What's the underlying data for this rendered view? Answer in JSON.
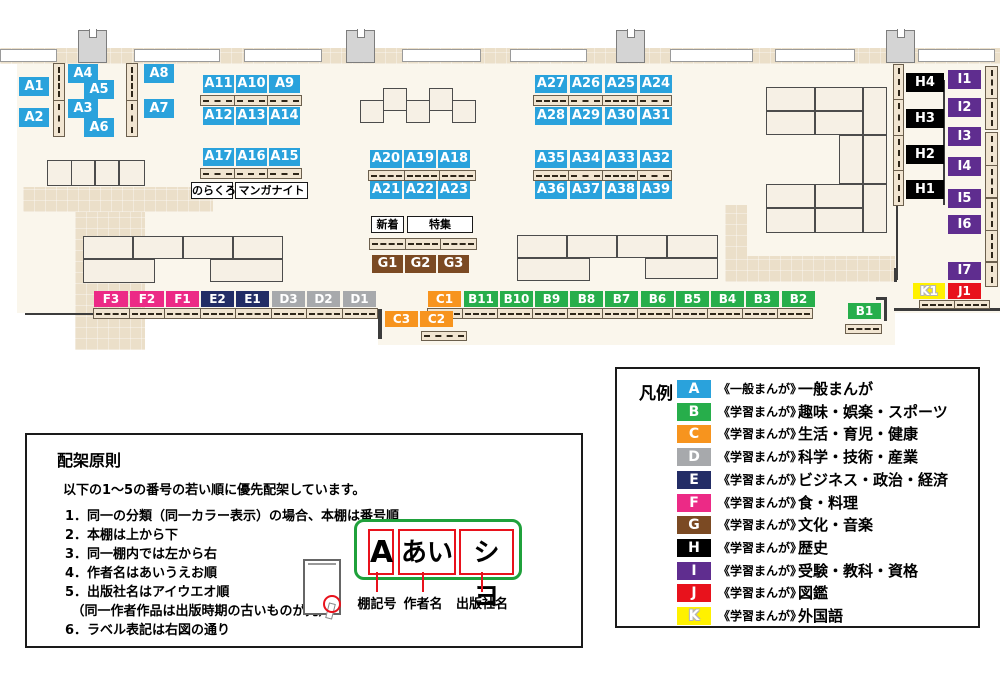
{
  "colors": {
    "A": "#2AA2DC",
    "B": "#27AE4B",
    "C": "#F7941E",
    "D": "#A7A9AC",
    "E": "#232D66",
    "F": "#EC2A86",
    "G": "#7B4A23",
    "H": "#000000",
    "I": "#5F2D8F",
    "J": "#E8121C",
    "K": "#FFF100"
  },
  "map": {
    "base": [
      [
        17,
        62,
        983,
        251
      ],
      [
        378,
        312,
        517,
        33
      ]
    ],
    "paths": [
      [
        0,
        48,
        1000,
        16
      ],
      [
        23,
        187,
        190,
        25
      ],
      [
        75,
        212,
        70,
        138
      ],
      [
        725,
        205,
        22,
        53
      ],
      [
        725,
        256,
        170,
        26
      ]
    ],
    "walls": [
      [
        0,
        49,
        57,
        13
      ],
      [
        134,
        49,
        86,
        13
      ],
      [
        244,
        49,
        78,
        13
      ],
      [
        402,
        49,
        79,
        13
      ],
      [
        510,
        49,
        77,
        13
      ],
      [
        670,
        49,
        83,
        13
      ],
      [
        775,
        49,
        80,
        13
      ],
      [
        918,
        49,
        77,
        13
      ]
    ],
    "pillars": [
      [
        78,
        30,
        29,
        33
      ],
      [
        346,
        30,
        29,
        33
      ],
      [
        616,
        30,
        29,
        33
      ],
      [
        886,
        30,
        29,
        33
      ]
    ],
    "tables": [
      [
        47,
        160,
        25,
        26
      ],
      [
        71,
        160,
        24,
        26
      ],
      [
        95,
        160,
        24,
        26
      ],
      [
        119,
        160,
        26,
        26
      ],
      [
        83,
        236,
        50,
        23
      ],
      [
        133,
        236,
        50,
        23
      ],
      [
        183,
        236,
        50,
        23
      ],
      [
        233,
        236,
        50,
        23
      ],
      [
        83,
        259,
        72,
        24
      ],
      [
        210,
        259,
        73,
        23
      ],
      [
        360,
        100,
        24,
        23
      ],
      [
        383,
        88,
        24,
        23
      ],
      [
        406,
        100,
        24,
        23
      ],
      [
        429,
        88,
        24,
        23
      ],
      [
        452,
        100,
        24,
        23
      ],
      [
        517,
        235,
        50,
        23
      ],
      [
        567,
        235,
        50,
        23
      ],
      [
        617,
        235,
        50,
        23
      ],
      [
        667,
        235,
        51,
        23
      ],
      [
        517,
        258,
        73,
        23
      ],
      [
        645,
        258,
        73,
        21
      ],
      [
        766,
        87,
        49,
        24
      ],
      [
        815,
        87,
        48,
        24
      ],
      [
        766,
        111,
        49,
        24
      ],
      [
        815,
        111,
        48,
        24
      ],
      [
        863,
        87,
        24,
        48
      ],
      [
        839,
        135,
        24,
        49
      ],
      [
        863,
        135,
        24,
        49
      ],
      [
        766,
        184,
        49,
        24
      ],
      [
        815,
        184,
        48,
        24
      ],
      [
        766,
        208,
        49,
        25
      ],
      [
        815,
        208,
        48,
        25
      ],
      [
        863,
        184,
        24,
        49
      ]
    ],
    "shelves_h": [
      [
        200,
        95,
        102,
        11,
        3
      ],
      [
        200,
        168,
        102,
        11,
        3
      ],
      [
        368,
        170,
        108,
        11,
        3
      ],
      [
        533,
        95,
        139,
        11,
        4
      ],
      [
        533,
        170,
        139,
        11,
        4
      ],
      [
        369,
        238,
        108,
        12,
        3
      ],
      [
        93,
        308,
        285,
        11,
        8
      ],
      [
        427,
        308,
        386,
        11,
        11
      ],
      [
        421,
        331,
        46,
        10,
        1
      ],
      [
        845,
        324,
        37,
        10,
        1
      ],
      [
        919,
        300,
        71,
        9,
        2
      ]
    ],
    "shelves_v": [
      [
        53,
        63,
        12,
        74,
        2
      ],
      [
        126,
        63,
        12,
        74,
        2
      ],
      [
        893,
        64,
        11,
        142,
        4
      ],
      [
        985,
        66,
        13,
        64,
        2
      ],
      [
        985,
        132,
        13,
        66,
        2
      ],
      [
        985,
        198,
        13,
        64,
        2
      ],
      [
        985,
        262,
        13,
        25,
        1
      ]
    ],
    "lines": [
      [
        25,
        313,
        68,
        2
      ],
      [
        378,
        309,
        4,
        30
      ],
      [
        884,
        297,
        3,
        24
      ],
      [
        876,
        297,
        11,
        3
      ],
      [
        894,
        268,
        3,
        14
      ],
      [
        894,
        308,
        106,
        3
      ],
      [
        943,
        80,
        2,
        125
      ],
      [
        896,
        206,
        2,
        74
      ]
    ],
    "labels": [
      {
        "t": "A1",
        "c": "A",
        "x": 19,
        "y": 77,
        "w": 30,
        "h": 19
      },
      {
        "t": "A2",
        "c": "A",
        "x": 19,
        "y": 108,
        "w": 30,
        "h": 19
      },
      {
        "t": "A4",
        "c": "A",
        "x": 68,
        "y": 64,
        "w": 30,
        "h": 19
      },
      {
        "t": "A5",
        "c": "A",
        "x": 84,
        "y": 80,
        "w": 30,
        "h": 19
      },
      {
        "t": "A3",
        "c": "A",
        "x": 68,
        "y": 99,
        "w": 30,
        "h": 19
      },
      {
        "t": "A6",
        "c": "A",
        "x": 84,
        "y": 118,
        "w": 30,
        "h": 19
      },
      {
        "t": "A8",
        "c": "A",
        "x": 144,
        "y": 64,
        "w": 30,
        "h": 19
      },
      {
        "t": "A7",
        "c": "A",
        "x": 144,
        "y": 99,
        "w": 30,
        "h": 19
      },
      {
        "t": "A11",
        "c": "A",
        "x": 203,
        "y": 75,
        "w": 31,
        "h": 18
      },
      {
        "t": "A10",
        "c": "A",
        "x": 236,
        "y": 75,
        "w": 31,
        "h": 18
      },
      {
        "t": "A9",
        "c": "A",
        "x": 269,
        "y": 75,
        "w": 31,
        "h": 18
      },
      {
        "t": "A12",
        "c": "A",
        "x": 203,
        "y": 107,
        "w": 31,
        "h": 18
      },
      {
        "t": "A13",
        "c": "A",
        "x": 236,
        "y": 107,
        "w": 31,
        "h": 18
      },
      {
        "t": "A14",
        "c": "A",
        "x": 269,
        "y": 107,
        "w": 31,
        "h": 18
      },
      {
        "t": "A17",
        "c": "A",
        "x": 203,
        "y": 148,
        "w": 31,
        "h": 18
      },
      {
        "t": "A16",
        "c": "A",
        "x": 236,
        "y": 148,
        "w": 31,
        "h": 18
      },
      {
        "t": "A15",
        "c": "A",
        "x": 269,
        "y": 148,
        "w": 31,
        "h": 18
      },
      {
        "t": "A20",
        "c": "A",
        "x": 370,
        "y": 150,
        "w": 32,
        "h": 18
      },
      {
        "t": "A19",
        "c": "A",
        "x": 404,
        "y": 150,
        "w": 32,
        "h": 18
      },
      {
        "t": "A18",
        "c": "A",
        "x": 438,
        "y": 150,
        "w": 32,
        "h": 18
      },
      {
        "t": "A21",
        "c": "A",
        "x": 370,
        "y": 181,
        "w": 32,
        "h": 18
      },
      {
        "t": "A22",
        "c": "A",
        "x": 404,
        "y": 181,
        "w": 32,
        "h": 18
      },
      {
        "t": "A23",
        "c": "A",
        "x": 438,
        "y": 181,
        "w": 32,
        "h": 18
      },
      {
        "t": "A27",
        "c": "A",
        "x": 535,
        "y": 75,
        "w": 32,
        "h": 18
      },
      {
        "t": "A26",
        "c": "A",
        "x": 570,
        "y": 75,
        "w": 32,
        "h": 18
      },
      {
        "t": "A25",
        "c": "A",
        "x": 605,
        "y": 75,
        "w": 32,
        "h": 18
      },
      {
        "t": "A24",
        "c": "A",
        "x": 640,
        "y": 75,
        "w": 32,
        "h": 18
      },
      {
        "t": "A28",
        "c": "A",
        "x": 535,
        "y": 107,
        "w": 32,
        "h": 18
      },
      {
        "t": "A29",
        "c": "A",
        "x": 570,
        "y": 107,
        "w": 32,
        "h": 18
      },
      {
        "t": "A30",
        "c": "A",
        "x": 605,
        "y": 107,
        "w": 32,
        "h": 18
      },
      {
        "t": "A31",
        "c": "A",
        "x": 640,
        "y": 107,
        "w": 32,
        "h": 18
      },
      {
        "t": "A35",
        "c": "A",
        "x": 535,
        "y": 150,
        "w": 32,
        "h": 18
      },
      {
        "t": "A34",
        "c": "A",
        "x": 570,
        "y": 150,
        "w": 32,
        "h": 18
      },
      {
        "t": "A33",
        "c": "A",
        "x": 605,
        "y": 150,
        "w": 32,
        "h": 18
      },
      {
        "t": "A32",
        "c": "A",
        "x": 640,
        "y": 150,
        "w": 32,
        "h": 18
      },
      {
        "t": "A36",
        "c": "A",
        "x": 535,
        "y": 181,
        "w": 32,
        "h": 18
      },
      {
        "t": "A37",
        "c": "A",
        "x": 570,
        "y": 181,
        "w": 32,
        "h": 18
      },
      {
        "t": "A38",
        "c": "A",
        "x": 605,
        "y": 181,
        "w": 32,
        "h": 18
      },
      {
        "t": "A39",
        "c": "A",
        "x": 640,
        "y": 181,
        "w": 32,
        "h": 18
      },
      {
        "t": "G1",
        "c": "G",
        "x": 372,
        "y": 255,
        "w": 31,
        "h": 18
      },
      {
        "t": "G2",
        "c": "G",
        "x": 405,
        "y": 255,
        "w": 31,
        "h": 18
      },
      {
        "t": "G3",
        "c": "G",
        "x": 438,
        "y": 255,
        "w": 31,
        "h": 18
      },
      {
        "t": "F3",
        "c": "F",
        "x": 94,
        "y": 291,
        "w": 34,
        "h": 16
      },
      {
        "t": "F2",
        "c": "F",
        "x": 130,
        "y": 291,
        "w": 34,
        "h": 16
      },
      {
        "t": "F1",
        "c": "F",
        "x": 166,
        "y": 291,
        "w": 33,
        "h": 16
      },
      {
        "t": "E2",
        "c": "E",
        "x": 201,
        "y": 291,
        "w": 33,
        "h": 16
      },
      {
        "t": "E1",
        "c": "E",
        "x": 236,
        "y": 291,
        "w": 33,
        "h": 16
      },
      {
        "t": "D3",
        "c": "D",
        "x": 272,
        "y": 291,
        "w": 33,
        "h": 16
      },
      {
        "t": "D2",
        "c": "D",
        "x": 307,
        "y": 291,
        "w": 33,
        "h": 16
      },
      {
        "t": "D1",
        "c": "D",
        "x": 343,
        "y": 291,
        "w": 33,
        "h": 16
      },
      {
        "t": "C1",
        "c": "C",
        "x": 428,
        "y": 291,
        "w": 33,
        "h": 16
      },
      {
        "t": "B11",
        "c": "B",
        "x": 464,
        "y": 291,
        "w": 34,
        "h": 16
      },
      {
        "t": "B10",
        "c": "B",
        "x": 500,
        "y": 291,
        "w": 33,
        "h": 16
      },
      {
        "t": "B9",
        "c": "B",
        "x": 535,
        "y": 291,
        "w": 33,
        "h": 16
      },
      {
        "t": "B8",
        "c": "B",
        "x": 570,
        "y": 291,
        "w": 33,
        "h": 16
      },
      {
        "t": "B7",
        "c": "B",
        "x": 605,
        "y": 291,
        "w": 33,
        "h": 16
      },
      {
        "t": "B6",
        "c": "B",
        "x": 641,
        "y": 291,
        "w": 33,
        "h": 16
      },
      {
        "t": "B5",
        "c": "B",
        "x": 676,
        "y": 291,
        "w": 33,
        "h": 16
      },
      {
        "t": "B4",
        "c": "B",
        "x": 711,
        "y": 291,
        "w": 33,
        "h": 16
      },
      {
        "t": "B3",
        "c": "B",
        "x": 746,
        "y": 291,
        "w": 33,
        "h": 16
      },
      {
        "t": "B2",
        "c": "B",
        "x": 782,
        "y": 291,
        "w": 33,
        "h": 16
      },
      {
        "t": "C3",
        "c": "C",
        "x": 385,
        "y": 311,
        "w": 33,
        "h": 16
      },
      {
        "t": "C2",
        "c": "C",
        "x": 420,
        "y": 311,
        "w": 33,
        "h": 16
      },
      {
        "t": "B1",
        "c": "B",
        "x": 848,
        "y": 303,
        "w": 33,
        "h": 16
      },
      {
        "t": "H4",
        "c": "H",
        "x": 906,
        "y": 73,
        "w": 38,
        "h": 19
      },
      {
        "t": "H3",
        "c": "H",
        "x": 906,
        "y": 109,
        "w": 38,
        "h": 19
      },
      {
        "t": "H2",
        "c": "H",
        "x": 906,
        "y": 145,
        "w": 38,
        "h": 19
      },
      {
        "t": "H1",
        "c": "H",
        "x": 906,
        "y": 180,
        "w": 38,
        "h": 19
      },
      {
        "t": "I1",
        "c": "I",
        "x": 948,
        "y": 70,
        "w": 33,
        "h": 19
      },
      {
        "t": "I2",
        "c": "I",
        "x": 948,
        "y": 98,
        "w": 33,
        "h": 19
      },
      {
        "t": "I3",
        "c": "I",
        "x": 948,
        "y": 127,
        "w": 33,
        "h": 19
      },
      {
        "t": "I4",
        "c": "I",
        "x": 948,
        "y": 157,
        "w": 33,
        "h": 19
      },
      {
        "t": "I5",
        "c": "I",
        "x": 948,
        "y": 189,
        "w": 33,
        "h": 19
      },
      {
        "t": "I6",
        "c": "I",
        "x": 948,
        "y": 215,
        "w": 33,
        "h": 19
      },
      {
        "t": "I7",
        "c": "I",
        "x": 948,
        "y": 262,
        "w": 33,
        "h": 18
      },
      {
        "t": "K1",
        "c": "K",
        "x": 913,
        "y": 283,
        "w": 32,
        "h": 16
      },
      {
        "t": "J1",
        "c": "J",
        "x": 948,
        "y": 283,
        "w": 33,
        "h": 16
      }
    ],
    "annotations": [
      {
        "text": "のらくろ",
        "name": "norakuro-label",
        "x": 191,
        "y": 182,
        "w": 42,
        "h": 17
      },
      {
        "text": "マンガナイト",
        "name": "manga-night-label",
        "x": 235,
        "y": 182,
        "w": 73,
        "h": 17
      },
      {
        "text": "新着",
        "name": "new-arrivals-label",
        "x": 371,
        "y": 216,
        "w": 33,
        "h": 17
      },
      {
        "text": "特集",
        "name": "special-feature-label",
        "x": 407,
        "y": 216,
        "w": 66,
        "h": 17
      }
    ]
  },
  "legend": {
    "title": "凡例",
    "entries": [
      {
        "letter": "A",
        "kind": "《一般まんが》",
        "category": "一般まんが"
      },
      {
        "letter": "B",
        "kind": "《学習まんが》",
        "category": "趣味・娯楽・スポーツ"
      },
      {
        "letter": "C",
        "kind": "《学習まんが》",
        "category": "生活・育児・健康"
      },
      {
        "letter": "D",
        "kind": "《学習まんが》",
        "category": "科学・技術・産業"
      },
      {
        "letter": "E",
        "kind": "《学習まんが》",
        "category": "ビジネス・政治・経済"
      },
      {
        "letter": "F",
        "kind": "《学習まんが》",
        "category": "食・料理"
      },
      {
        "letter": "G",
        "kind": "《学習まんが》",
        "category": "文化・音楽"
      },
      {
        "letter": "H",
        "kind": "《学習まんが》",
        "category": "歴史"
      },
      {
        "letter": "I",
        "kind": "《学習まんが》",
        "category": "受験・教科・資格"
      },
      {
        "letter": "J",
        "kind": "《学習まんが》",
        "category": "図鑑"
      },
      {
        "letter": "K",
        "kind": "《学習まんが》",
        "category": "外国語"
      }
    ]
  },
  "principles": {
    "title": "配架原則",
    "intro": "以下の1～5の番号の若い順に優先配架しています。",
    "items": [
      "1．同一の分類（同一カラー表示）の場合、本棚は番号順",
      "2．本棚は上から下",
      "3．同一棚内では左から右",
      "4．作者名はあいうえお順",
      "5．出版社名はアイウエオ順",
      "　（同一作者作品は出版時期の古いものが先）",
      "6．ラベル表記は右図の通り"
    ]
  },
  "label_diagram": {
    "segments": [
      {
        "text": "A",
        "caption": "棚記号"
      },
      {
        "text": "あい",
        "caption": "作者名"
      },
      {
        "text": "シヨ",
        "caption": "出版社名"
      }
    ]
  }
}
